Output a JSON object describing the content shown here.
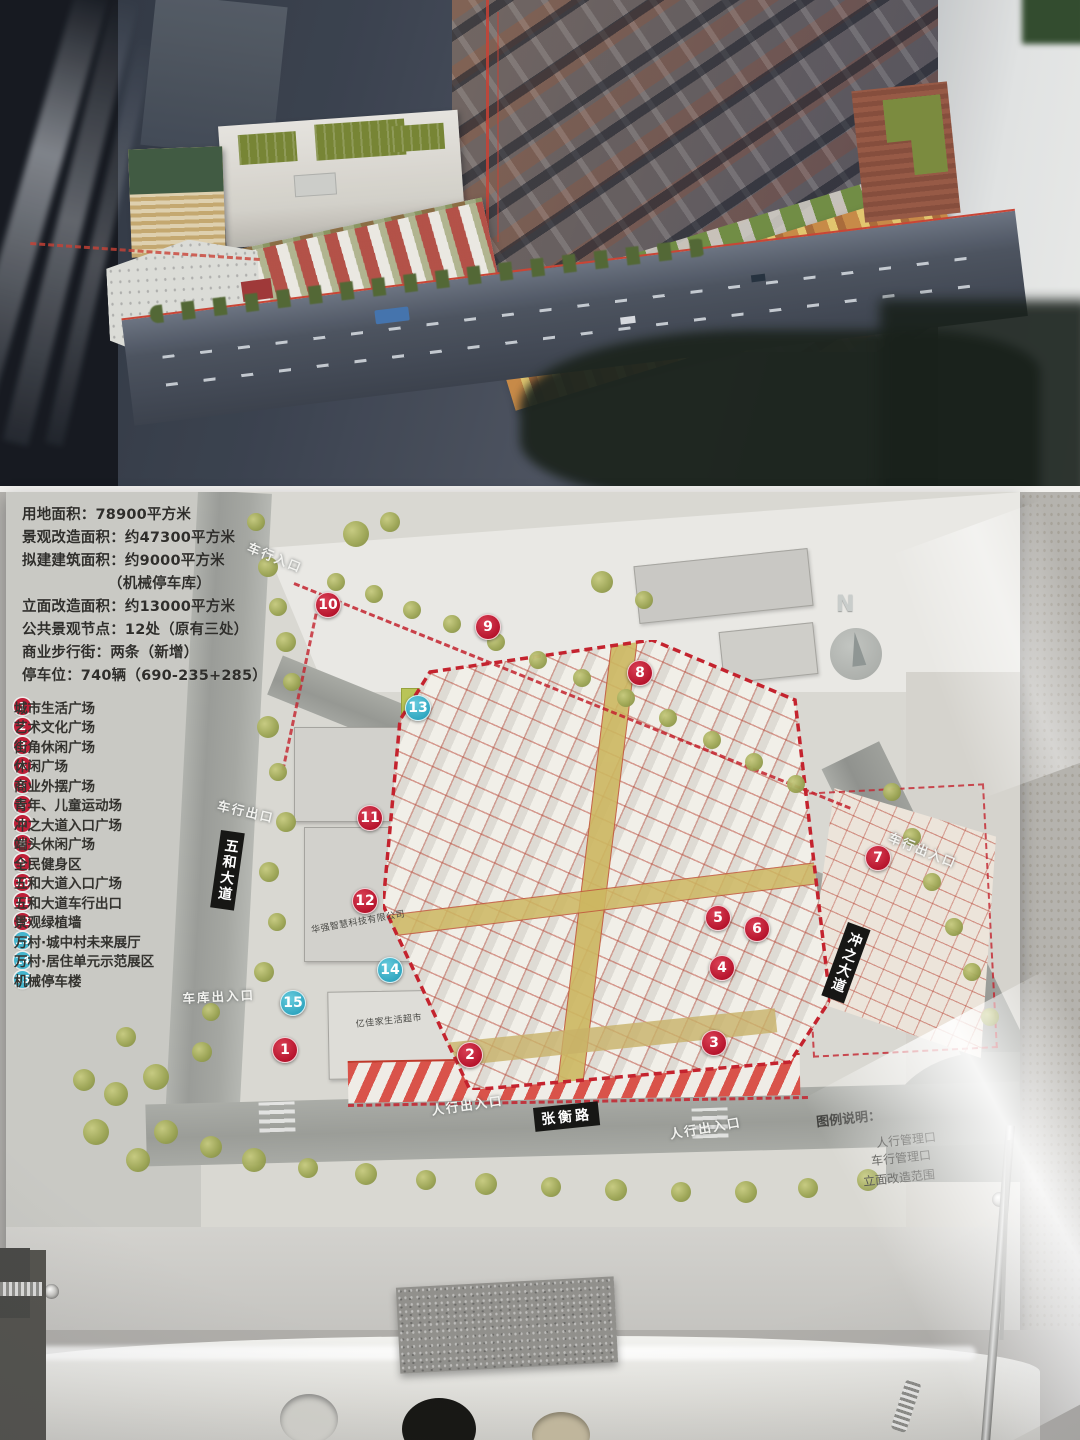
{
  "board": {
    "stats_lines": [
      {
        "text": "用地面积：78900平方米",
        "indent": false
      },
      {
        "text": "景观改造面积：约47300平方米",
        "indent": false
      },
      {
        "text": "拟建建筑面积：约9000平方米",
        "indent": false
      },
      {
        "text": "（机械停车库）",
        "indent": true
      },
      {
        "text": "立面改造面积：约13000平方米",
        "indent": false
      },
      {
        "text": "公共景观节点：12处（原有三处）",
        "indent": false
      },
      {
        "text": "商业步行街：两条（新增）",
        "indent": false
      },
      {
        "text": "停车位：740辆（690-235+285）",
        "indent": false
      }
    ],
    "legend_items": [
      {
        "n": "1",
        "label": "城市生活广场",
        "color": "red"
      },
      {
        "n": "2",
        "label": "艺术文化广场",
        "color": "red"
      },
      {
        "n": "3",
        "label": "街角休闲广场",
        "color": "red"
      },
      {
        "n": "4",
        "label": "休闲广场",
        "color": "red"
      },
      {
        "n": "5",
        "label": "商业外摆广场",
        "color": "red"
      },
      {
        "n": "6",
        "label": "青年、儿童运动场",
        "color": "red"
      },
      {
        "n": "7",
        "label": "冲之大道入口广场",
        "color": "red"
      },
      {
        "n": "8",
        "label": "端头休闲广场",
        "color": "red"
      },
      {
        "n": "9",
        "label": "全民健身区",
        "color": "red"
      },
      {
        "n": "10",
        "label": "五和大道入口广场",
        "color": "red"
      },
      {
        "n": "11",
        "label": "五和大道车行出口",
        "color": "red"
      },
      {
        "n": "12",
        "label": "景观绿植墙",
        "color": "red"
      },
      {
        "n": "13",
        "label": "万村·城中村未来展厅",
        "color": "cyan"
      },
      {
        "n": "14",
        "label": "万村·居住单元示范展区",
        "color": "cyan"
      },
      {
        "n": "15",
        "label": "机械停车楼",
        "color": "cyan"
      }
    ],
    "map": {
      "north_label": "N",
      "badges": [
        {
          "n": "1",
          "x": 285,
          "y": 1050,
          "color": "red"
        },
        {
          "n": "2",
          "x": 470,
          "y": 1055,
          "color": "red"
        },
        {
          "n": "3",
          "x": 714,
          "y": 1043,
          "color": "red"
        },
        {
          "n": "4",
          "x": 722,
          "y": 968,
          "color": "red"
        },
        {
          "n": "5",
          "x": 718,
          "y": 918,
          "color": "red"
        },
        {
          "n": "6",
          "x": 757,
          "y": 929,
          "color": "red"
        },
        {
          "n": "7",
          "x": 878,
          "y": 858,
          "color": "red"
        },
        {
          "n": "8",
          "x": 640,
          "y": 673,
          "color": "red"
        },
        {
          "n": "9",
          "x": 488,
          "y": 627,
          "color": "red"
        },
        {
          "n": "10",
          "x": 328,
          "y": 605,
          "color": "red"
        },
        {
          "n": "11",
          "x": 370,
          "y": 818,
          "color": "red"
        },
        {
          "n": "12",
          "x": 365,
          "y": 901,
          "color": "red"
        },
        {
          "n": "13",
          "x": 418,
          "y": 708,
          "color": "cyan"
        },
        {
          "n": "14",
          "x": 390,
          "y": 970,
          "color": "cyan"
        },
        {
          "n": "15",
          "x": 293,
          "y": 1003,
          "color": "cyan"
        }
      ],
      "labels": [
        {
          "text": "车行入口",
          "x": 252,
          "y": 537,
          "rot": 22,
          "style": "white",
          "name": "entrance-label-vehicle-in-north"
        },
        {
          "text": "车行出口",
          "x": 220,
          "y": 795,
          "rot": 13,
          "style": "white",
          "name": "entrance-label-vehicle-out-west"
        },
        {
          "text": "五和大道",
          "x": 221,
          "y": 830,
          "rot": 8,
          "style": "blackv",
          "name": "street-label-wuhe-avenue"
        },
        {
          "text": "车行出入口",
          "x": 893,
          "y": 827,
          "rot": 22,
          "style": "white",
          "name": "entrance-label-vehicle-east"
        },
        {
          "text": "冲之大道",
          "x": 848,
          "y": 922,
          "rot": 20,
          "style": "blackv",
          "name": "street-label-chongzhi-avenue"
        },
        {
          "text": "车库出入口",
          "x": 182,
          "y": 988,
          "rot": -3,
          "style": "white",
          "name": "entrance-label-garage"
        },
        {
          "text": "人行出入口",
          "x": 430,
          "y": 1100,
          "rot": -8,
          "style": "white",
          "name": "entrance-label-pedestrian-left"
        },
        {
          "text": "张衡路",
          "x": 533,
          "y": 1108,
          "rot": -6,
          "style": "black",
          "name": "street-label-zhangheng-road"
        },
        {
          "text": "人行出入口",
          "x": 668,
          "y": 1124,
          "rot": -10,
          "style": "white",
          "name": "entrance-label-pedestrian-right"
        },
        {
          "text": "华强智慧科技有限公司",
          "x": 310,
          "y": 923,
          "rot": -10,
          "style": "dark",
          "name": "building-label-company"
        },
        {
          "text": "亿佳家生活超市",
          "x": 355,
          "y": 1017,
          "rot": -6,
          "style": "dark",
          "name": "building-label-supermarket"
        }
      ],
      "side_legend": {
        "title": {
          "text": "图例说明：",
          "x": 816,
          "y": 1108,
          "rot": -6
        },
        "items": [
          {
            "text": "人行管理口",
            "x": 876,
            "y": 1131,
            "rot": -6
          },
          {
            "text": "车行管理口",
            "x": 871,
            "y": 1149,
            "rot": -6
          },
          {
            "text": "立面改造范围",
            "x": 863,
            "y": 1169,
            "rot": -6
          }
        ]
      }
    }
  }
}
